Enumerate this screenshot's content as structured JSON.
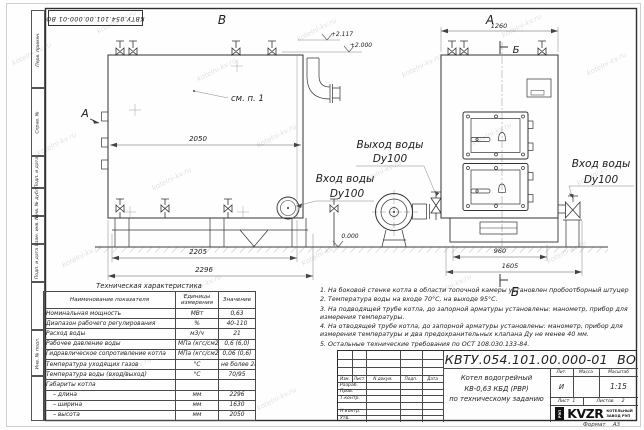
{
  "watermark": "kotelni-kv.ru",
  "frame": {
    "top_stamp": "КВТУ.054.101.00.000-01 ВО",
    "margin_labels": [
      "Перв. примен.",
      "Справ. №",
      "Подп. и дата",
      "Инв. № дубл.",
      "Взам. инв. №",
      "Подп. и дата",
      "Инв. № подл."
    ],
    "format_label": "Формат",
    "format_value": "А3"
  },
  "drawing": {
    "view_b": "В",
    "view_a": "А",
    "view_a_arrow": "А",
    "section_b": "Б",
    "see_note": "см. п. 1",
    "elev1": "+2.117",
    "elev2": "+2.000",
    "elev0": "0.000",
    "dim_2050": "2050",
    "dim_2205": "2205",
    "dim_2296": "2296",
    "dim_1260": "1260",
    "dim_960": "960",
    "dim_1605": "1605",
    "outlet": "Выход воды",
    "inlet": "Вход воды",
    "dn": "Dy100"
  },
  "table": {
    "title": "Техническая характеристика",
    "headers": [
      "Наименование показателя",
      "Единицы измерения",
      "Значение"
    ],
    "rows": [
      [
        "Номинальная мощность",
        "МВт",
        "0,63"
      ],
      [
        "Диапазон рабочего регулирования",
        "%",
        "40-110"
      ],
      [
        "Расход воды",
        "м3/ч",
        "21"
      ],
      [
        "Рабочее давление воды",
        "МПа (кгс/см2)",
        "0,6 (6,0)"
      ],
      [
        "Гидравлическое сопротивление котла",
        "МПа (кгс/см2)",
        "0,06 (0,6)"
      ],
      [
        "Температура уходящих газов",
        "°С",
        "не более 280"
      ],
      [
        "Температура воды (вход/выход)",
        "°С",
        "70/95"
      ],
      [
        "Габариты котла",
        "",
        ""
      ],
      [
        "– длина",
        "мм",
        "2296"
      ],
      [
        "– ширина",
        "мм",
        "1630"
      ],
      [
        "– высота",
        "мм",
        "2050"
      ]
    ]
  },
  "notes": [
    "1. На боковой стенке котла в области топочной камеры установлен пробоотборный штуцер",
    "2. Температура воды на входе 70°С, на выходе 95°С.",
    "3. На подводящей трубе котла, до запорной арматуры установлены: манометр, прибор для измерения температуры.",
    "4. На отводящей трубе котла, до запорной арматуры установлены: манометр, прибор для измерения температуры и два предохранительных клапана Ду не менее 40 мм.",
    "5. Остальные технические требования по ОСТ 108.030.133-84."
  ],
  "title_block": {
    "designation": "КВТУ.054.101.00.000-01 ВО",
    "name_lines": [
      "Котел водогрейный",
      "КВ-0,63 КБД (РВР)",
      "по техническому заданию"
    ],
    "header_cols": [
      "Изм.",
      "Лист",
      "N докум.",
      "Подп.",
      "Дата"
    ],
    "row_labels": [
      "Разраб.",
      "Пров.",
      "Т.контр.",
      "",
      "Н.контр.",
      "Утв."
    ],
    "lit_label": "Лит.",
    "mass_label": "Масса",
    "scale_label": "Масштаб",
    "lit_value": "И",
    "scale_value": "1:15",
    "sheet_label": "Лист",
    "sheet_value": "1",
    "sheets_label": "Листов",
    "sheets_value": "2",
    "logo_mark": "РЭП",
    "logo_name": "KVZR",
    "logo_sub1": "КОТЕЛЬНЫЙ",
    "logo_sub2": "ЗАВОД РЭП"
  }
}
